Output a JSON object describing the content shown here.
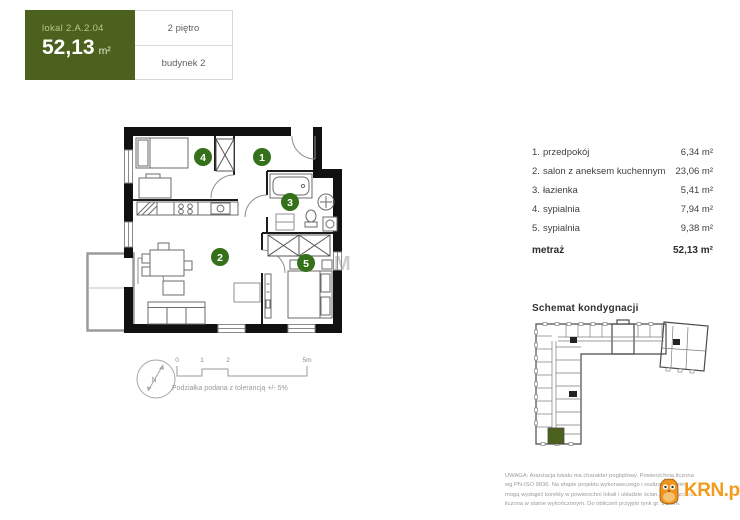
{
  "header": {
    "unit_label": "lokal 2.A.2.04",
    "area_value": "52,13",
    "area_unit": "m²",
    "floor_label": "2 piętro",
    "building_label": "budynek 2"
  },
  "plan": {
    "markers": {
      "m1": "1",
      "m2": "2",
      "m3": "3",
      "m4": "4",
      "m5": "5"
    },
    "watermark": "M"
  },
  "compass": {
    "label": "N"
  },
  "scale_bar": {
    "ticks": {
      "t0": "0",
      "t1": "1",
      "t2": "2",
      "t3": "5m"
    },
    "note": "Podziałka podana z tolerancją +/- 5%"
  },
  "room_list": {
    "items": [
      {
        "no": "1.",
        "name": "przedpokój",
        "area": "6,34 m²"
      },
      {
        "no": "2.",
        "name": "salon z aneksem kuchennym",
        "area": "23,06 m²"
      },
      {
        "no": "3.",
        "name": "łazienka",
        "area": "5,41 m²"
      },
      {
        "no": "4.",
        "name": "sypialnia",
        "area": "7,94 m²"
      },
      {
        "no": "5.",
        "name": "sypialnia",
        "area": "9,38 m²"
      }
    ],
    "total_label": "metraż",
    "total_area": "52,13 m²"
  },
  "schematic": {
    "title": "Schemat kondygnacji"
  },
  "footer": {
    "disclaimer_lines": [
      "UWAGA: Aranżacja lokalu ma charakter poglądowy. Powierzchnia liczona",
      "wg PN-ISO 9836. Na etapie projektu wykonawczego i realizacji obiektu",
      "mogą wystąpić korekty w powierzchni lokali i układzie ścian. Powierzchnia",
      "liczona w stanie wykończonym. Do obliczeń przyjęto tynk gr. 1,5 cm."
    ],
    "logo_text": "KRN.pl"
  },
  "colors": {
    "brand_green": "#4b611d",
    "marker_green": "#35701a",
    "logo_orange": "#f49b1d"
  }
}
